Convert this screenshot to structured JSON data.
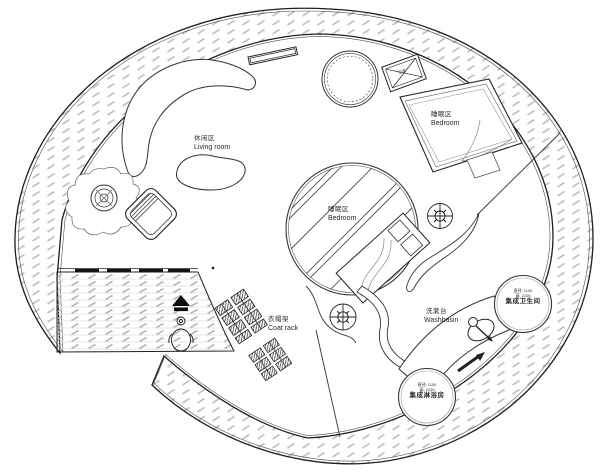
{
  "document": {
    "type": "architectural floor plan",
    "shape": "circular tiny home"
  },
  "labels": {
    "living_room": {
      "zh": "休闲区",
      "en": "Living room"
    },
    "bedroom_upper": {
      "zh": "睡眠区",
      "en": "Bedroom"
    },
    "bedroom_center": {
      "zh": "睡眠区",
      "en": "Bedroom"
    },
    "coat_rack": {
      "zh": "衣帽架",
      "en": "Coat rack"
    },
    "washbasin": {
      "zh": "洗漱台",
      "en": "Washbasin"
    },
    "toilet_pod": {
      "spec_diameter": "直径: 1100",
      "spec_height": "高: 2100",
      "name": "集成卫生间"
    },
    "shower_pod": {
      "spec_diameter": "直径: 1100",
      "spec_height": "高: 2100",
      "name": "集成淋浴房"
    },
    "ac_unit": {
      "name": "空调"
    }
  },
  "colors": {
    "line": "#222222",
    "hatch": "#c0c0c0",
    "deck_line": "#d8d8d8",
    "text": "#2b2b2b"
  }
}
